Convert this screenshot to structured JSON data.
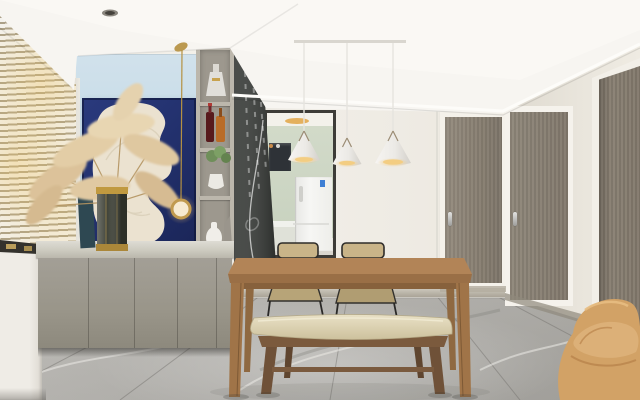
{
  "scene": {
    "kind": "interior-photograph",
    "room": "modern dining room",
    "style": "minimalist scandinavian",
    "lighting": "warm daylight through venetian blinds"
  },
  "counts": {
    "pendant_cone_lights": 3,
    "dining_chairs": 2,
    "cabinet_doors": 4,
    "interior_doors": 3,
    "shelf_compartments": 4
  },
  "objects": [
    {
      "name": "window-blinds",
      "desc": "white venetian blinds with warm sunlight"
    },
    {
      "name": "accent-wall",
      "desc": "light blue painted wall"
    },
    {
      "name": "abstract-artwork",
      "desc": "navy canvas with cream textured blob"
    },
    {
      "name": "pampas-grass",
      "desc": "dried beige pampas in dark glass vase with gold bands"
    },
    {
      "name": "brass-ring-pendant",
      "desc": "thin brass cord lamp with glowing ring"
    },
    {
      "name": "display-shelf",
      "desc": "open shelf tower with decanter, wine bottles, plant, vases"
    },
    {
      "name": "chalkboard-panel",
      "desc": "dark chalkboard side panel with chalk marks"
    },
    {
      "name": "kitchen-doorway",
      "desc": "dark framed opening showing sage kitchen and white fridge"
    },
    {
      "name": "pendant-lights",
      "desc": "three white cone pendants on ceiling rail"
    },
    {
      "name": "dining-table",
      "desc": "walnut wood rectangular table"
    },
    {
      "name": "rattan-chairs",
      "desc": "two black metal chairs with woven seats"
    },
    {
      "name": "bench",
      "desc": "cream leather cushion bench with wood legs"
    },
    {
      "name": "sideboard-cabinet",
      "desc": "floating grey cabinet with stone counter"
    },
    {
      "name": "interior-doors",
      "desc": "grey-brown veneer doors with steel handles"
    },
    {
      "name": "lounge-chair",
      "desc": "camel fabric chair in right corner"
    },
    {
      "name": "marble-floor",
      "desc": "grey veined marble tiles"
    }
  ],
  "palette": {
    "ceiling": "#f7f5f1",
    "wall_cream": "#efece5",
    "wall_right": "#e8e4db",
    "accent_blue": "#c6dbe7",
    "artwork_navy": "#22306c",
    "artwork_cream": "#eae1cf",
    "blind_slat": "#f4f2ed",
    "sun_glow": "#eec669",
    "cabinet_grey": "#999589",
    "countertop": "#cccabf",
    "floor_marble": "#b2b0ab",
    "table_wood": "#b28457",
    "bench_cushion": "#e2d9bb",
    "bench_wood": "#74553c",
    "chair_rattan": "#c4b184",
    "chair_frame": "#2e2c29",
    "door_wood": "#8b8376",
    "kitchen_sage": "#ccd5c4",
    "fridge_white": "#f4f4f2",
    "pendant_white": "#edebe7",
    "pendant_glow": "#e8b96a",
    "brass": "#c2a05c",
    "lounge_tan": "#d2a266",
    "chalkboard": "#3a3d3a"
  }
}
